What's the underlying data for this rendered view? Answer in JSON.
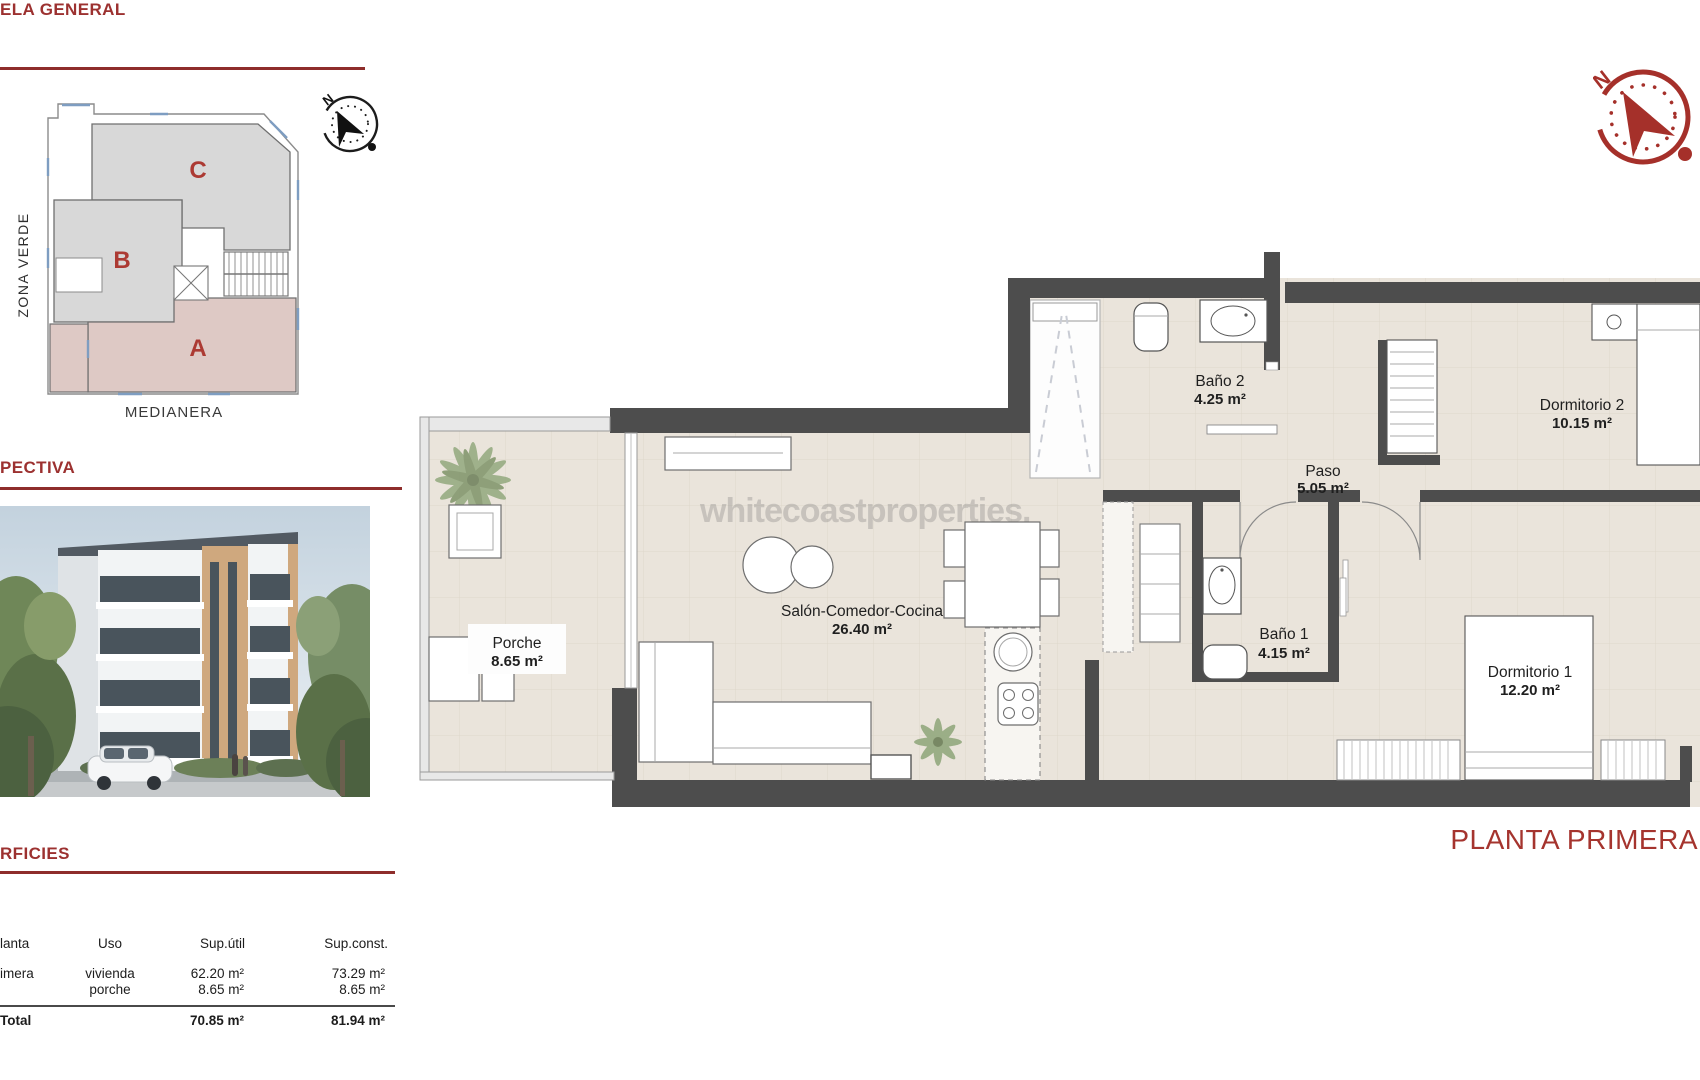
{
  "colors": {
    "accent_red": "#9c3130",
    "rule_red": "#8e2d2b",
    "wall_gray": "#4d4d4d",
    "floor_beige": "#eae4db",
    "block_gray": "#d8d8d8",
    "block_pink": "#dec9c5",
    "compass_red": "#a5302a"
  },
  "sections": {
    "parcela": {
      "title": "ELA GENERAL",
      "zona_verde": "ZONA VERDE",
      "medianera": "MEDIANERA",
      "blocks": [
        {
          "label": "C"
        },
        {
          "label": "B"
        },
        {
          "label": "A"
        }
      ],
      "compass_n": "N"
    },
    "perspectiva": {
      "title": "PECTIVA"
    },
    "superficies": {
      "title": "RFICIES",
      "table": {
        "headers": [
          "lanta",
          "Uso",
          "Sup.útil",
          "Sup.const."
        ],
        "rows": [
          {
            "planta": "imera",
            "uso": "vivienda",
            "sup_util": "62.20 m²",
            "sup_const": "73.29 m²"
          },
          {
            "planta": "",
            "uso": "porche",
            "sup_util": "8.65 m²",
            "sup_const": "8.65 m²"
          }
        ],
        "total": {
          "label": "Total",
          "sup_util": "70.85 m²",
          "sup_const": "81.94 m²"
        }
      }
    }
  },
  "floorplan": {
    "watermark": "whitecoastproperties.",
    "plan_label": "PLANTA PRIMERA",
    "compass_n": "N",
    "rooms": [
      {
        "name": "Porche",
        "area": "8.65 m²"
      },
      {
        "name": "Salón-Comedor-Cocina",
        "area": "26.40 m²"
      },
      {
        "name": "Baño 2",
        "area": "4.25 m²"
      },
      {
        "name": "Paso",
        "area": "5.05 m²"
      },
      {
        "name": "Dormitorio 2",
        "area": "10.15 m²"
      },
      {
        "name": "Baño 1",
        "area": "4.15 m²"
      },
      {
        "name": "Dormitorio 1",
        "area": "12.20 m²"
      }
    ]
  }
}
